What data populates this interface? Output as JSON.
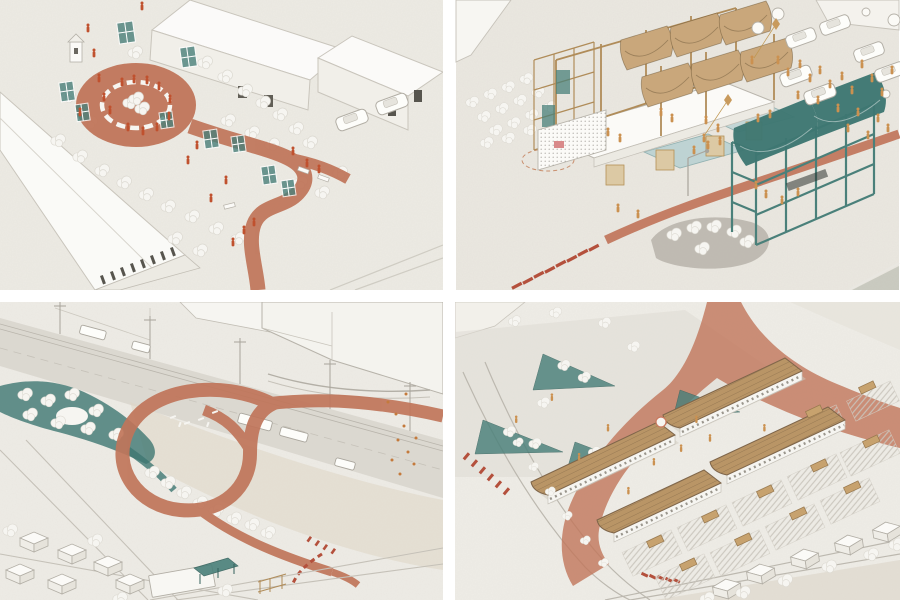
{
  "artwork": {
    "type": "architectural-axonometric-illustration-set",
    "panel_count": 4,
    "grid": "2x2",
    "gutter_color": "#ffffff"
  },
  "palette": {
    "paper": "#edebe4",
    "paper_warm": "#eae6de",
    "terracotta": "#c0755a",
    "terracotta_deep": "#b85038",
    "red_dash": "#b4503c",
    "teal": "#4a807a",
    "teal_deep": "#3e7772",
    "pool_blue": "#bed3d3",
    "tan": "#c9a77b",
    "tan_roof": "#b99566",
    "tan_dark": "#8a6e4b",
    "figure_red": "#c0512e",
    "figure_orange": "#cb9150",
    "line_gray": "#b3afa6",
    "road_gray": "#d6d2c9",
    "sand": "#ded5c5",
    "veg_white": "#f6f5f1",
    "veg_shadow": "#dcd9d1"
  },
  "panels": [
    {
      "id": "courtyard-garden"
    },
    {
      "id": "pavilion-plaza"
    },
    {
      "id": "interchange-loop-park"
    },
    {
      "id": "market-plaza"
    }
  ]
}
